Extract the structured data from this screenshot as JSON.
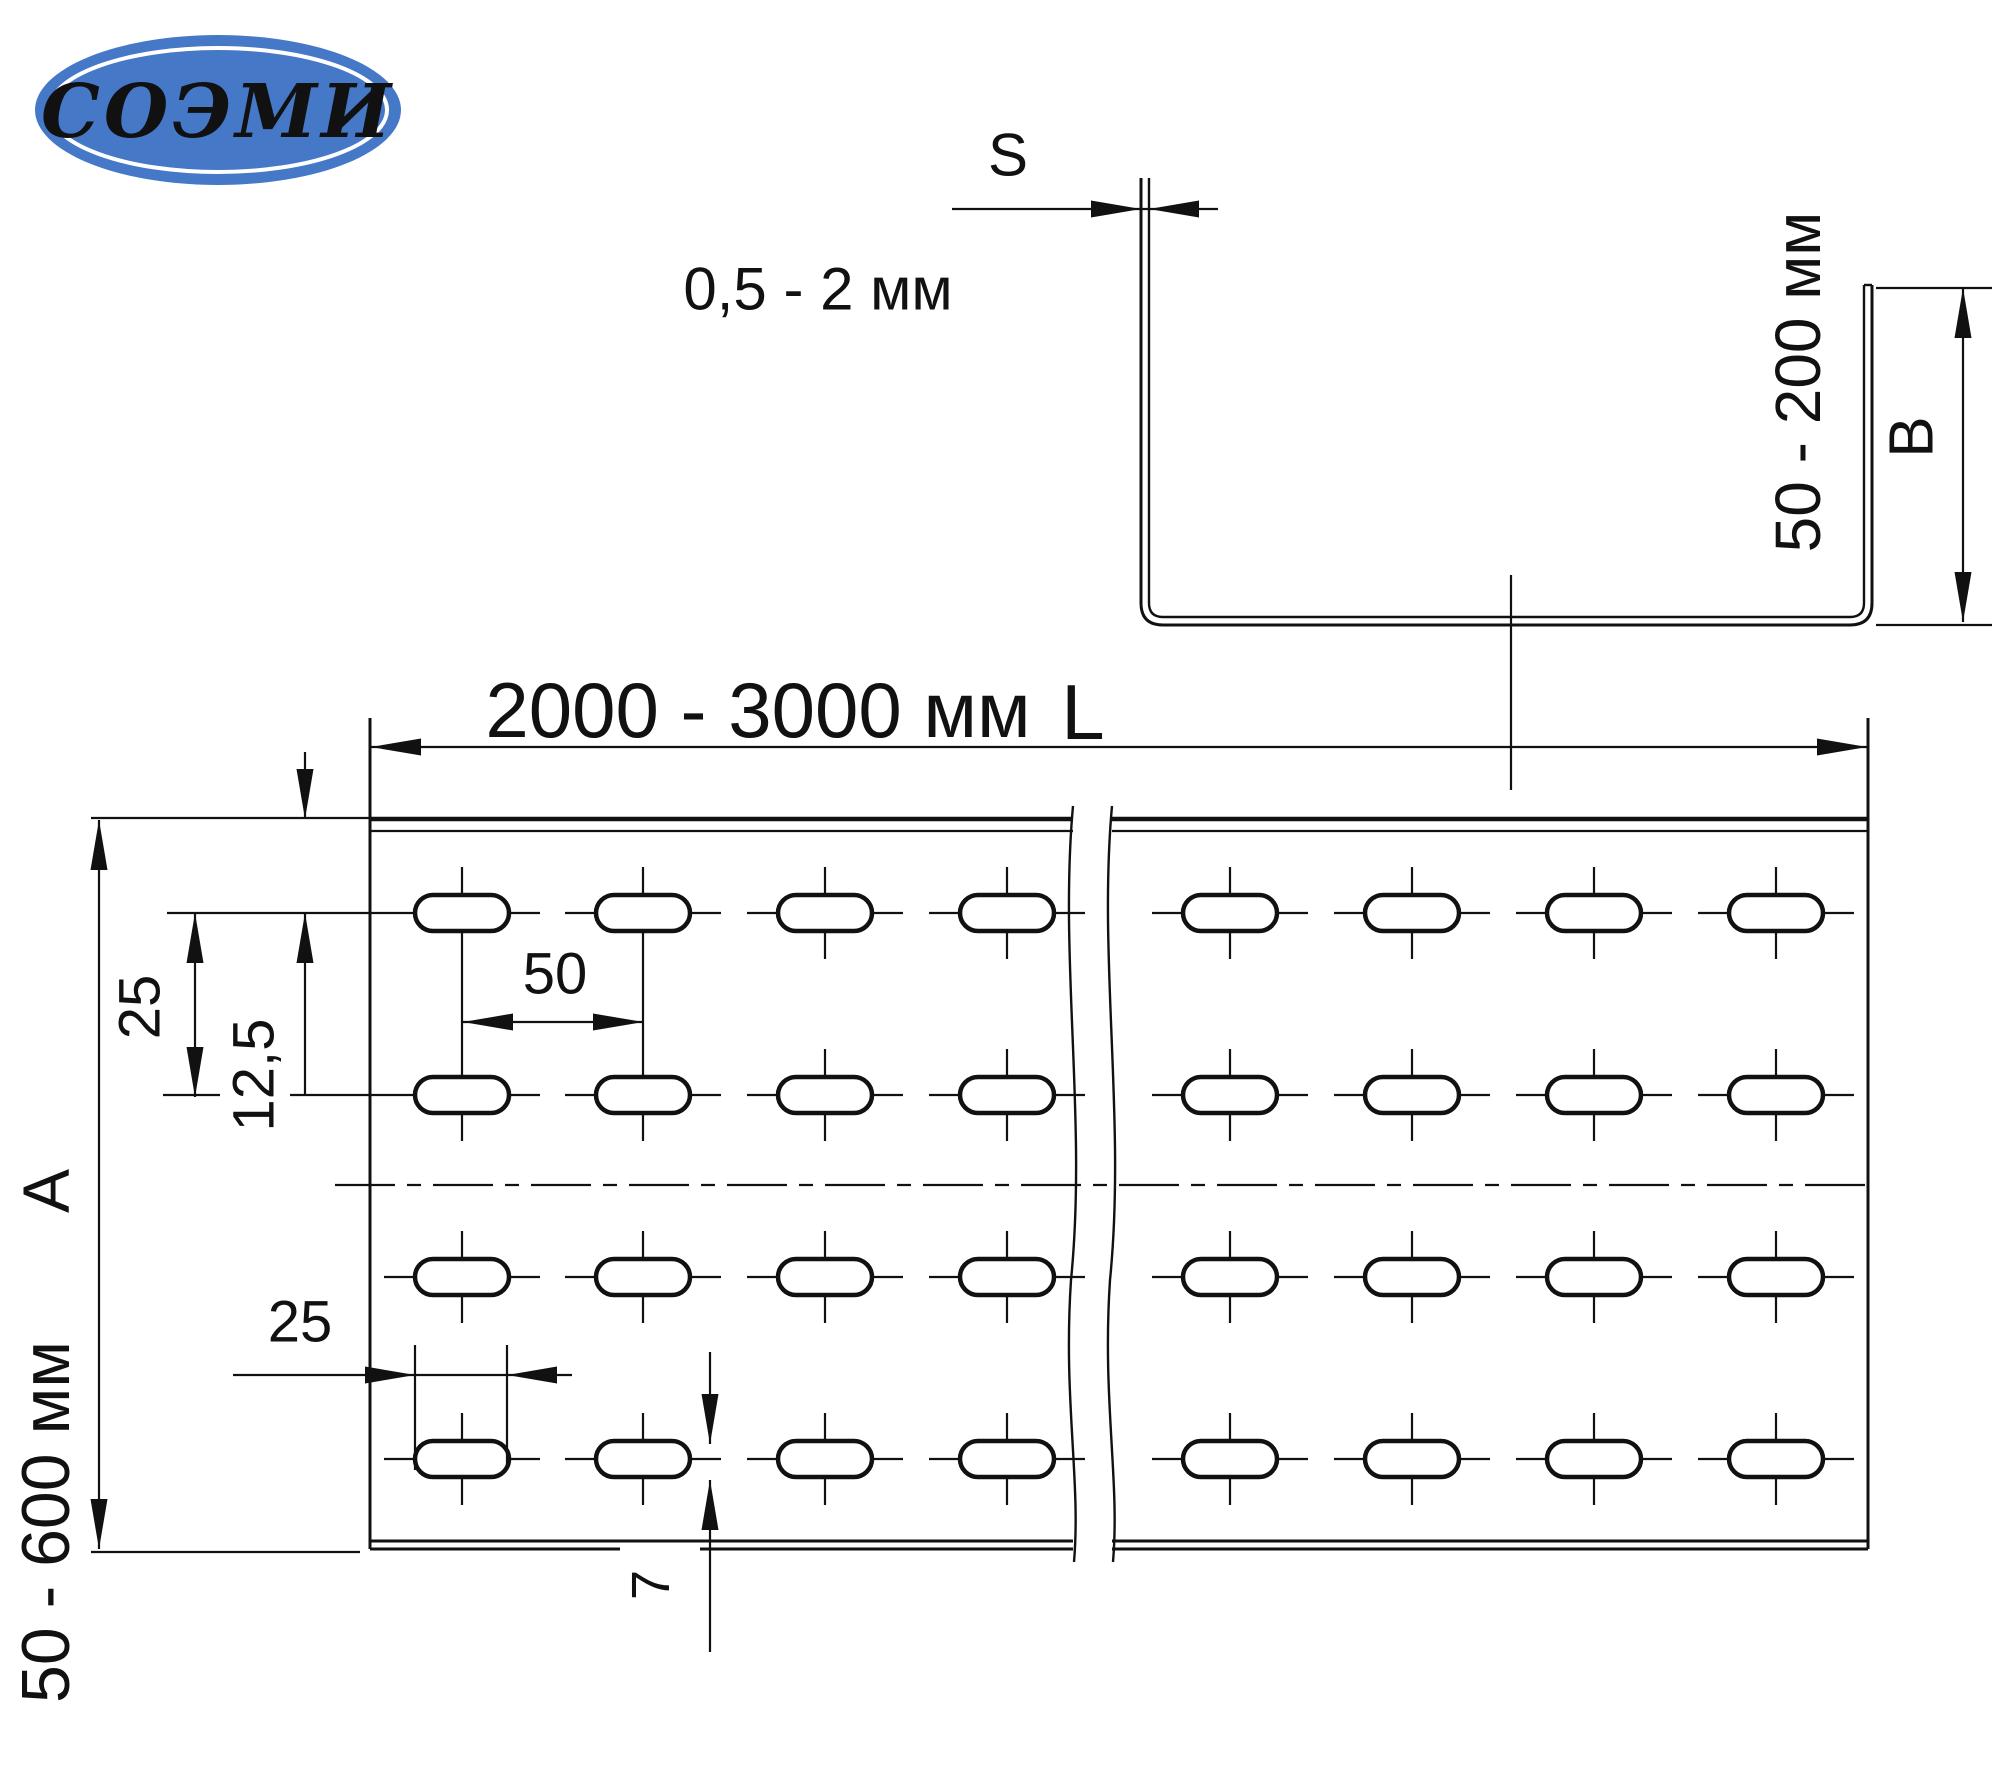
{
  "logo": {
    "text": "СОЭМИ",
    "bg_color": "#4678c8",
    "text_color": "#ffffff"
  },
  "section": {
    "s_label": "S",
    "thickness_range": "0,5 - 2 мм",
    "height_range": "50 - 200 мм",
    "height_label": "B"
  },
  "plan": {
    "length_range": "2000 - 3000 мм",
    "length_label": "L",
    "width_range": "50 - 600 мм",
    "width_label": "A",
    "row_spacing": "25",
    "edge_offset": "12,5",
    "hole_pitch": "50",
    "slot_length": "25",
    "slot_width": "7"
  },
  "drawing": {
    "canvas": {
      "w": 2000,
      "h": 1771
    },
    "line_color": "#111111",
    "section_bounds": {
      "left": 1141,
      "right": 1872,
      "top": 178,
      "flange_top": 285,
      "bottom": 625,
      "sheet_gap": 8
    },
    "plan_bounds": {
      "left": 370,
      "right": 1868,
      "top": 819,
      "top_inner": 831,
      "bottom_inner": 1541,
      "bottom": 1549
    },
    "break_lines": {
      "x1": 1073,
      "x2": 1112
    },
    "slots": {
      "rows_y": [
        913,
        1095,
        1277,
        1459
      ],
      "cols_x": [
        462,
        643,
        825,
        1007,
        1230,
        1412,
        1594,
        1776
      ],
      "slot_w": 94,
      "slot_h": 36
    },
    "axis_y": 1185
  }
}
